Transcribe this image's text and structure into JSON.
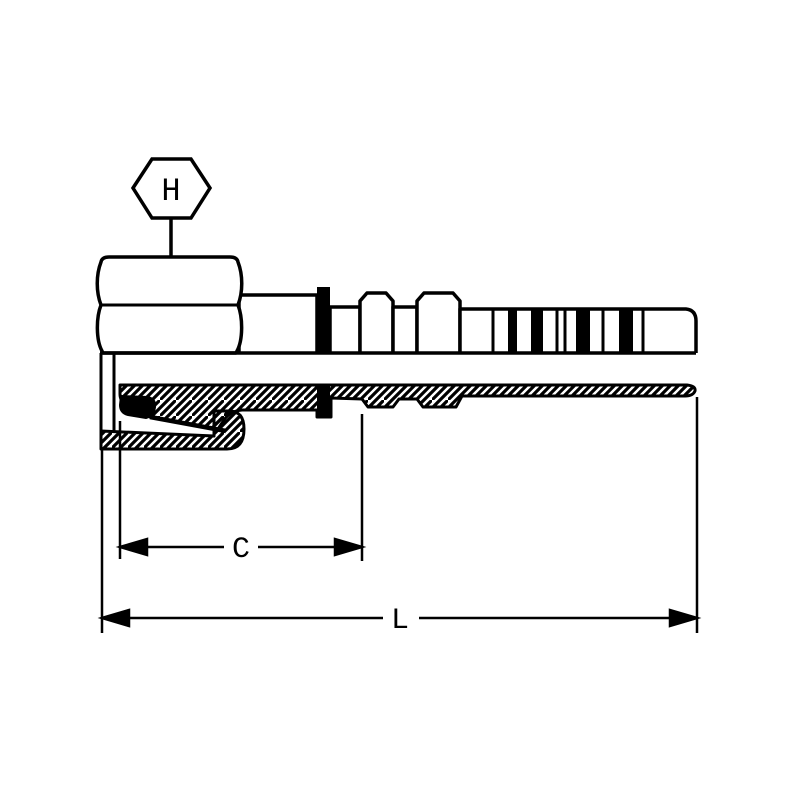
{
  "diagram": {
    "callouts": {
      "hex_label": "H",
      "dim_c_label": "C",
      "dim_l_label": "L"
    },
    "colors": {
      "line": "#000000",
      "background": "#ffffff"
    }
  }
}
